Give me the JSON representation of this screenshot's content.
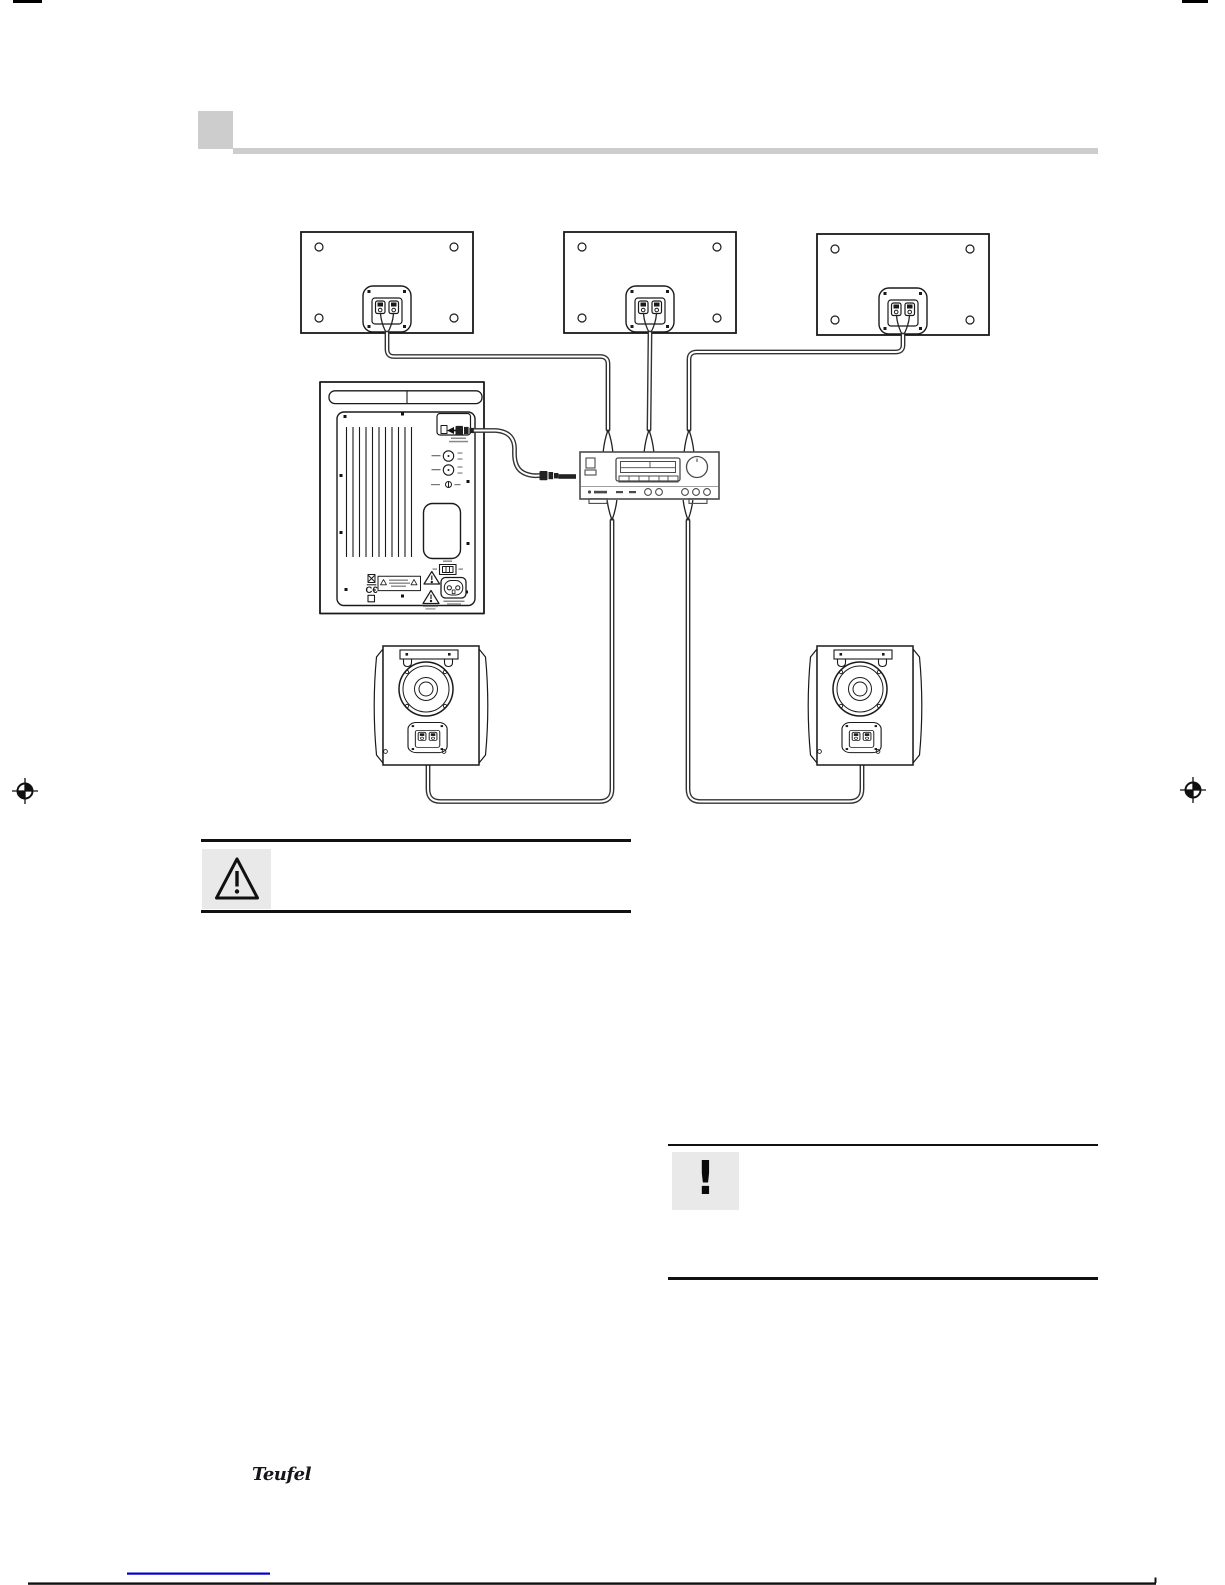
{
  "page": {
    "width": 1225,
    "height": 1585,
    "background": "#ffffff"
  },
  "colors": {
    "header_gray": "#cdcdcd",
    "callout_box_gray": "#e9e9e9",
    "rule_black": "#111111",
    "footer_rule_blue": "#0000cc",
    "diagram_outline": "#1a1a1a",
    "receiver_outline": "#4a4a4a",
    "cable_dark": "#333333"
  },
  "callouts": {
    "warning": {
      "icon": "warning-triangle"
    },
    "important": {
      "glyph": "!"
    }
  },
  "branding": {
    "logo_text": "Teufel"
  },
  "subwoofer_labels": {
    "ce_mark": "C€"
  },
  "print_marks": {
    "registration": "crosshair-target"
  }
}
